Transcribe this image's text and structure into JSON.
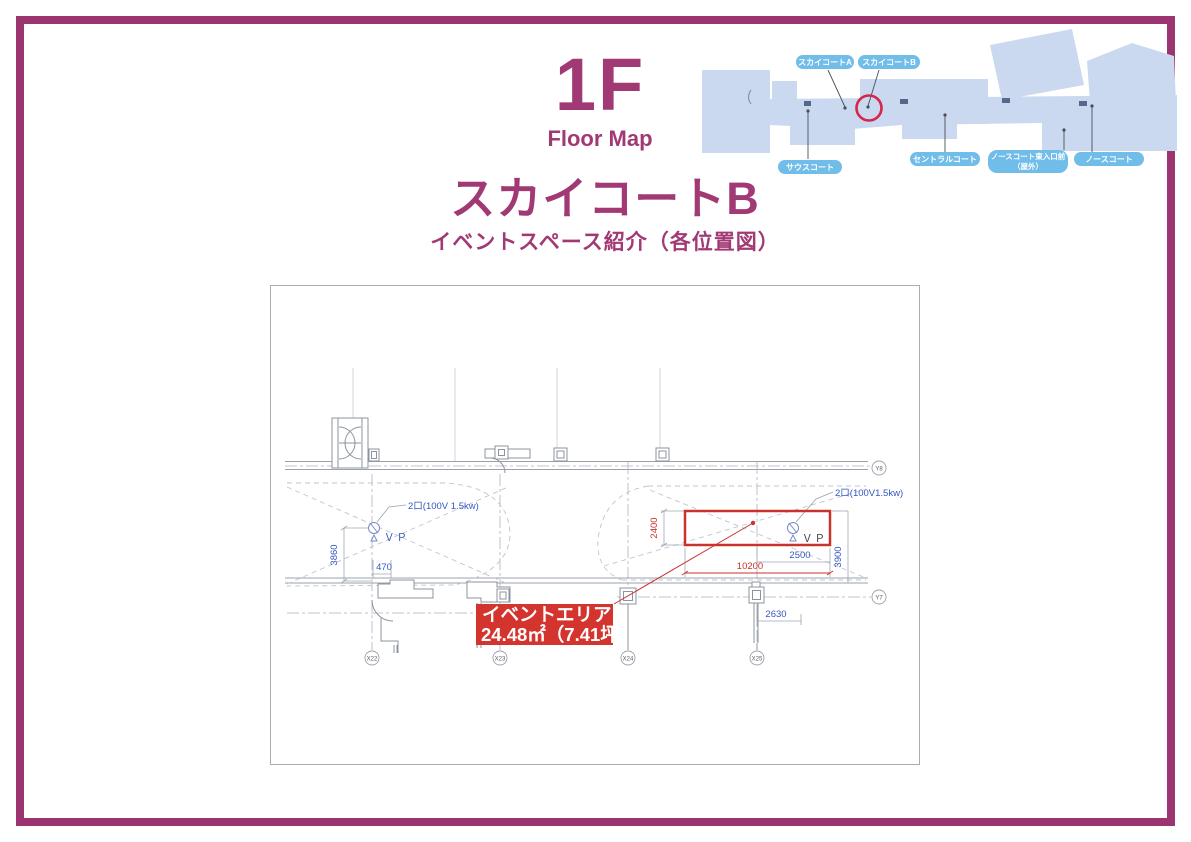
{
  "page": {
    "frame_color": "#9C3470",
    "background": "#FFFFFF"
  },
  "header": {
    "floor": "1F",
    "caption": "Floor Map",
    "accent_color": "#A13A74"
  },
  "title": {
    "main": "スカイコートB",
    "subtitle": "イベントスペース紹介（各位置図）"
  },
  "minimap": {
    "labels": {
      "sky_a": "スカイコートA",
      "sky_b": "スカイコートB",
      "south": "サウスコート",
      "central": "セントラルコート",
      "north_east_1": "ノースコート東入口前",
      "north_east_2": "（屋外）",
      "north": "ノースコート"
    },
    "colors": {
      "building": "#CBD9F0",
      "pill": "#71BDE9",
      "pill_text": "#FFFFFF",
      "highlight_circle": "#D6264B"
    }
  },
  "floorplan": {
    "grid": {
      "x22": "X22",
      "x23": "X23",
      "x24": "X24",
      "x25": "X25",
      "y8": "Y8",
      "y7": "Y7"
    },
    "dims": {
      "left_height": "3860",
      "left_offset": "470",
      "event_height": "2400",
      "event_width": "10200",
      "right_offset": "2500",
      "right_height": "3900",
      "column_offset": "2630"
    },
    "outlet_left": {
      "label": "2口(100V 1.5kw)",
      "vp": "ＶＰ"
    },
    "outlet_right": {
      "label": "2口(100V1.5kw)",
      "vp": "ＶＰ"
    },
    "event_label": {
      "line1": "イベントエリア",
      "line2": "24.48㎡（7.41坪）"
    },
    "colors": {
      "dim_blue": "#3457C0",
      "accent_red": "#C8332D",
      "label_bg": "#D4342E",
      "line_gray": "#9BA1AA"
    }
  }
}
